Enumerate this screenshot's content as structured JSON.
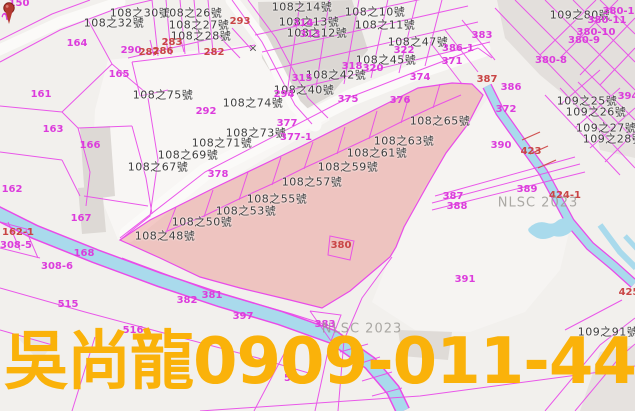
{
  "watermark": {
    "text": "吳尚龍0909-011-448",
    "color": "#FAB20A"
  },
  "map": {
    "source_watermark": "NLSC 2023",
    "colors": {
      "background": "#F2F0ED",
      "parcel_line_magenta": "#E94BE9",
      "parcel_number_magenta": "#DC3CDC",
      "parcel_number_red": "#C94545",
      "house_label_black": "#3E3E3E",
      "stream_cyan": "#A9DAEC",
      "highlight_pink": "#E98F8A",
      "building_gray": "#DBD7D3",
      "watermark_yellow": "#FAB20A",
      "pin_red": "#B5382F"
    },
    "labels": [
      {
        "t": "108之30號",
        "x": 140,
        "y": 13,
        "c": "b"
      },
      {
        "t": "108之32號",
        "x": 114,
        "y": 23,
        "c": "b"
      },
      {
        "t": "108之26號",
        "x": 192,
        "y": 13,
        "c": "b"
      },
      {
        "t": "108之27號",
        "x": 199,
        "y": 25,
        "c": "b"
      },
      {
        "t": "108之28號",
        "x": 201,
        "y": 36,
        "c": "b"
      },
      {
        "t": "108之14號",
        "x": 302,
        "y": 7,
        "c": "b"
      },
      {
        "t": "108之13號",
        "x": 309,
        "y": 22,
        "c": "b"
      },
      {
        "t": "108之12號",
        "x": 317,
        "y": 33,
        "c": "b"
      },
      {
        "t": "108之10號",
        "x": 375,
        "y": 12,
        "c": "b"
      },
      {
        "t": "108之11號",
        "x": 385,
        "y": 25,
        "c": "b"
      },
      {
        "t": "108之45號",
        "x": 386,
        "y": 60,
        "c": "b"
      },
      {
        "t": "108之47號",
        "x": 418,
        "y": 42,
        "c": "b"
      },
      {
        "t": "108之42號",
        "x": 336,
        "y": 75,
        "c": "b"
      },
      {
        "t": "108之40號",
        "x": 304,
        "y": 90,
        "c": "b"
      },
      {
        "t": "108之75號",
        "x": 163,
        "y": 95,
        "c": "b"
      },
      {
        "t": "108之74號",
        "x": 253,
        "y": 103,
        "c": "b"
      },
      {
        "t": "108之73號",
        "x": 256,
        "y": 133,
        "c": "b"
      },
      {
        "t": "108之71號",
        "x": 222,
        "y": 143,
        "c": "b"
      },
      {
        "t": "108之69號",
        "x": 188,
        "y": 155,
        "c": "b"
      },
      {
        "t": "108之67號",
        "x": 158,
        "y": 167,
        "c": "b"
      },
      {
        "t": "108之65號",
        "x": 440,
        "y": 121,
        "c": "b"
      },
      {
        "t": "108之63號",
        "x": 404,
        "y": 141,
        "c": "b"
      },
      {
        "t": "108之61號",
        "x": 377,
        "y": 153,
        "c": "b"
      },
      {
        "t": "108之59號",
        "x": 348,
        "y": 167,
        "c": "b"
      },
      {
        "t": "108之57號",
        "x": 312,
        "y": 182,
        "c": "b"
      },
      {
        "t": "108之55號",
        "x": 277,
        "y": 199,
        "c": "b"
      },
      {
        "t": "108之53號",
        "x": 246,
        "y": 211,
        "c": "b"
      },
      {
        "t": "108之50號",
        "x": 202,
        "y": 222,
        "c": "b"
      },
      {
        "t": "108之48號",
        "x": 165,
        "y": 236,
        "c": "b"
      },
      {
        "t": "109之80號",
        "x": 580,
        "y": 15,
        "c": "b"
      },
      {
        "t": "109之25號",
        "x": 587,
        "y": 101,
        "c": "b"
      },
      {
        "t": "109之26號",
        "x": 596,
        "y": 112,
        "c": "b"
      },
      {
        "t": "109之27號",
        "x": 606,
        "y": 128,
        "c": "b"
      },
      {
        "t": "109之28號",
        "x": 613,
        "y": 139,
        "c": "b"
      },
      {
        "t": "109之91號",
        "x": 608,
        "y": 332,
        "c": "b"
      },
      {
        "t": "150",
        "x": 19,
        "y": 4,
        "c": "m"
      },
      {
        "t": "25",
        "x": 9,
        "y": 14,
        "c": "m",
        "rot": -58
      },
      {
        "t": "164",
        "x": 77,
        "y": 44,
        "c": "m"
      },
      {
        "t": "161",
        "x": 41,
        "y": 95,
        "c": "m"
      },
      {
        "t": "163",
        "x": 53,
        "y": 130,
        "c": "m"
      },
      {
        "t": "165",
        "x": 119,
        "y": 75,
        "c": "m"
      },
      {
        "t": "166",
        "x": 90,
        "y": 146,
        "c": "m"
      },
      {
        "t": "162",
        "x": 12,
        "y": 190,
        "c": "m"
      },
      {
        "t": "167",
        "x": 81,
        "y": 219,
        "c": "m"
      },
      {
        "t": "168",
        "x": 84,
        "y": 254,
        "c": "m"
      },
      {
        "t": "308-5",
        "x": 16,
        "y": 246,
        "c": "m"
      },
      {
        "t": "308-6",
        "x": 57,
        "y": 267,
        "c": "m"
      },
      {
        "t": "515",
        "x": 68,
        "y": 305,
        "c": "m"
      },
      {
        "t": "516",
        "x": 133,
        "y": 331,
        "c": "m"
      },
      {
        "t": "382",
        "x": 187,
        "y": 301,
        "c": "m"
      },
      {
        "t": "381",
        "x": 212,
        "y": 296,
        "c": "m"
      },
      {
        "t": "397",
        "x": 243,
        "y": 317,
        "c": "m"
      },
      {
        "t": "383",
        "x": 325,
        "y": 325,
        "c": "m"
      },
      {
        "t": "290",
        "x": 131,
        "y": 51,
        "c": "m"
      },
      {
        "t": "292",
        "x": 206,
        "y": 112,
        "c": "m"
      },
      {
        "t": "294",
        "x": 284,
        "y": 95,
        "c": "m"
      },
      {
        "t": "377",
        "x": 287,
        "y": 124,
        "c": "m"
      },
      {
        "t": "377-1",
        "x": 296,
        "y": 138,
        "c": "m"
      },
      {
        "t": "378",
        "x": 218,
        "y": 175,
        "c": "m"
      },
      {
        "t": "315",
        "x": 302,
        "y": 79,
        "c": "m"
      },
      {
        "t": "314",
        "x": 303,
        "y": 24,
        "c": "m"
      },
      {
        "t": "313",
        "x": 310,
        "y": 35,
        "c": "m"
      },
      {
        "t": "318",
        "x": 352,
        "y": 67,
        "c": "m"
      },
      {
        "t": "320",
        "x": 373,
        "y": 69,
        "c": "m"
      },
      {
        "t": "322",
        "x": 404,
        "y": 51,
        "c": "m"
      },
      {
        "t": "375",
        "x": 348,
        "y": 100,
        "c": "m"
      },
      {
        "t": "376",
        "x": 400,
        "y": 101,
        "c": "m"
      },
      {
        "t": "374",
        "x": 420,
        "y": 78,
        "c": "m"
      },
      {
        "t": "383",
        "x": 482,
        "y": 36,
        "c": "m"
      },
      {
        "t": "386-1",
        "x": 458,
        "y": 49,
        "c": "m"
      },
      {
        "t": "371",
        "x": 452,
        "y": 62,
        "c": "m"
      },
      {
        "t": "386",
        "x": 511,
        "y": 88,
        "c": "m"
      },
      {
        "t": "372",
        "x": 506,
        "y": 110,
        "c": "m"
      },
      {
        "t": "390",
        "x": 501,
        "y": 146,
        "c": "m"
      },
      {
        "t": "391",
        "x": 465,
        "y": 280,
        "c": "m"
      },
      {
        "t": "387",
        "x": 453,
        "y": 197,
        "c": "m"
      },
      {
        "t": "388",
        "x": 457,
        "y": 207,
        "c": "m"
      },
      {
        "t": "389",
        "x": 527,
        "y": 190,
        "c": "m"
      },
      {
        "t": "394",
        "x": 628,
        "y": 97,
        "c": "m"
      },
      {
        "t": "380-8",
        "x": 551,
        "y": 61,
        "c": "m"
      },
      {
        "t": "380-9",
        "x": 584,
        "y": 41,
        "c": "m"
      },
      {
        "t": "380-10",
        "x": 596,
        "y": 33,
        "c": "m"
      },
      {
        "t": "380-11",
        "x": 607,
        "y": 21,
        "c": "m"
      },
      {
        "t": "380-12",
        "x": 622,
        "y": 12,
        "c": "m"
      },
      {
        "t": "52",
        "x": 291,
        "y": 379,
        "c": "m"
      },
      {
        "t": "162-1",
        "x": 18,
        "y": 233,
        "c": "r"
      },
      {
        "t": "282",
        "x": 214,
        "y": 53,
        "c": "r"
      },
      {
        "t": "283",
        "x": 172,
        "y": 43,
        "c": "r"
      },
      {
        "t": "286",
        "x": 163,
        "y": 52,
        "c": "r"
      },
      {
        "t": "287",
        "x": 149,
        "y": 53,
        "c": "r"
      },
      {
        "t": "293",
        "x": 240,
        "y": 22,
        "c": "r"
      },
      {
        "t": "380",
        "x": 341,
        "y": 246,
        "c": "r"
      },
      {
        "t": "423",
        "x": 531,
        "y": 152,
        "c": "r"
      },
      {
        "t": "424-1",
        "x": 565,
        "y": 196,
        "c": "r"
      },
      {
        "t": "425",
        "x": 629,
        "y": 293,
        "c": "r"
      },
      {
        "t": "387",
        "x": 487,
        "y": 80,
        "c": "r"
      },
      {
        "t": "×",
        "x": 253,
        "y": 48,
        "c": "x"
      },
      {
        "t": "NLSC 2023",
        "x": 538,
        "y": 203,
        "c": "g"
      },
      {
        "t": "NLSC 2023",
        "x": 362,
        "y": 329,
        "c": "g"
      }
    ]
  }
}
